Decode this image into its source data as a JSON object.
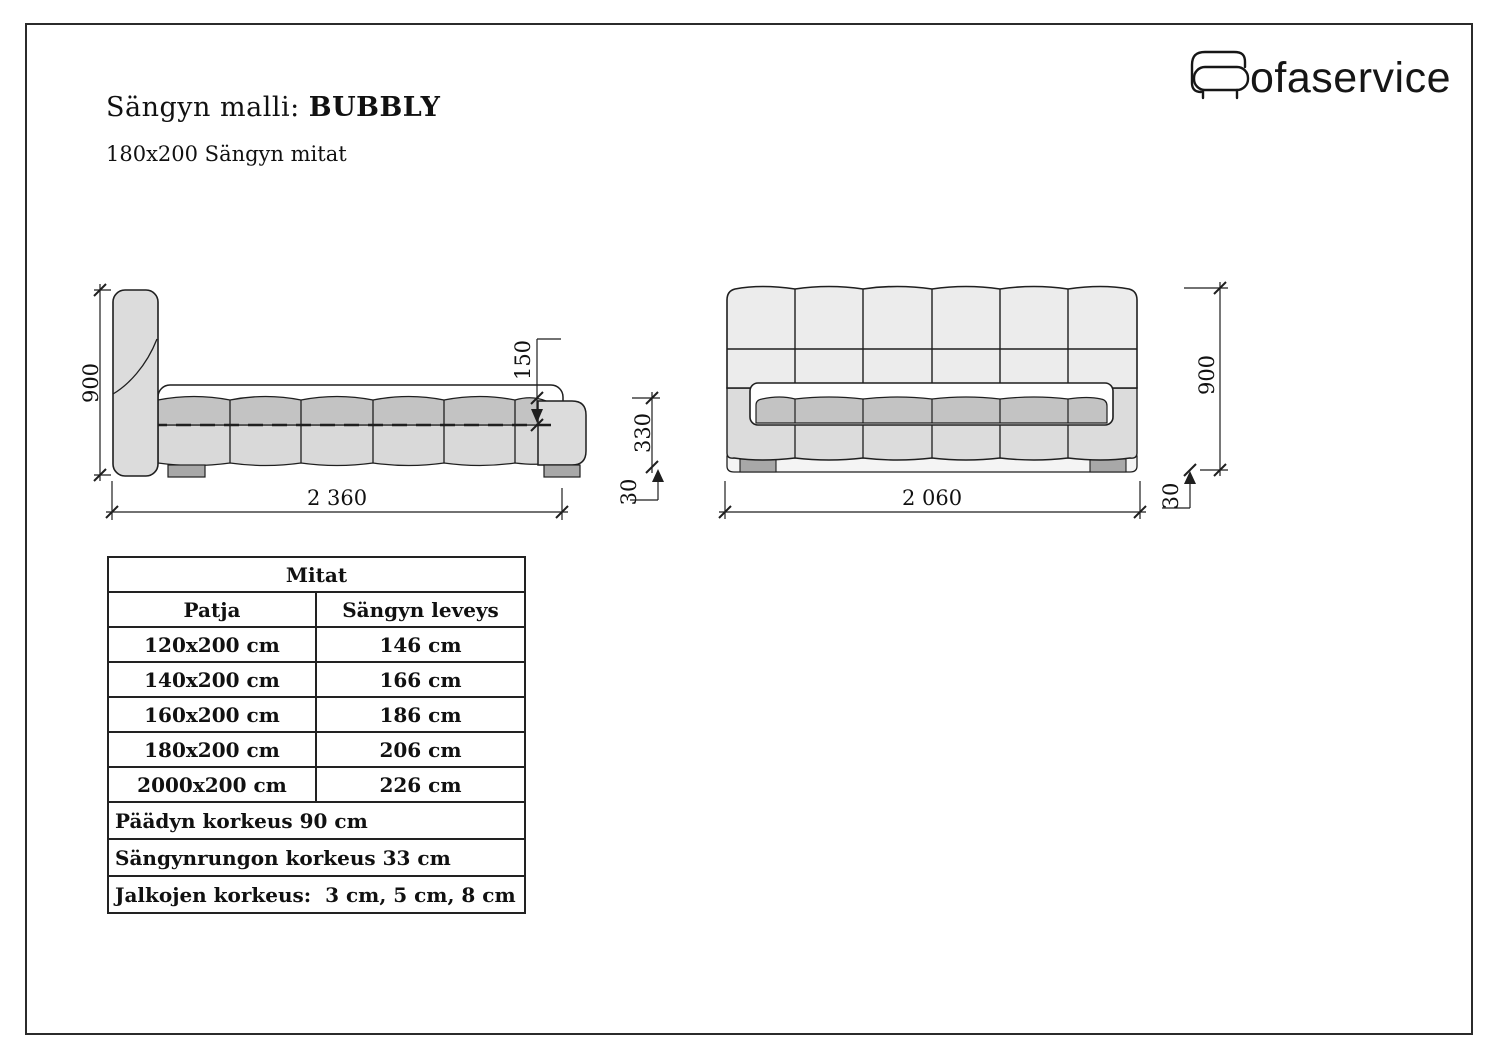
{
  "header": {
    "title_label": "Sängyn malli:",
    "model_name": "BUBBLY",
    "subtitle": "180x200 Sängyn mitat",
    "logo_text": "ofaservice"
  },
  "colors": {
    "bed_fill": "#dcdcdc",
    "headboard_fill": "#ececec",
    "mattress_fill": "#c3c3c3",
    "feet_fill": "#a8a8a8",
    "line": "#1f1f1f"
  },
  "drawings": {
    "side": {
      "height_mm": "900",
      "length_mm": "2 360",
      "mattress_mm": "150",
      "frame_mm": "330",
      "leg_mm": "30"
    },
    "front": {
      "height_mm": "900",
      "width_mm": "2 060",
      "leg_mm": "30"
    }
  },
  "table": {
    "title": "Mitat",
    "col_headers": [
      "Patja",
      "Sängyn leveys"
    ],
    "rows": [
      [
        "120x200 cm",
        "146 cm"
      ],
      [
        "140x200 cm",
        "166 cm"
      ],
      [
        "160x200 cm",
        "186 cm"
      ],
      [
        "180x200 cm",
        "206 cm"
      ],
      [
        "2000x200 cm",
        "226 cm"
      ]
    ],
    "notes": [
      "Päädyn korkeus 90 cm",
      "Sängynrungon korkeus 33 cm",
      "Jalkojen korkeus:  3 cm, 5 cm, 8 cm"
    ]
  }
}
